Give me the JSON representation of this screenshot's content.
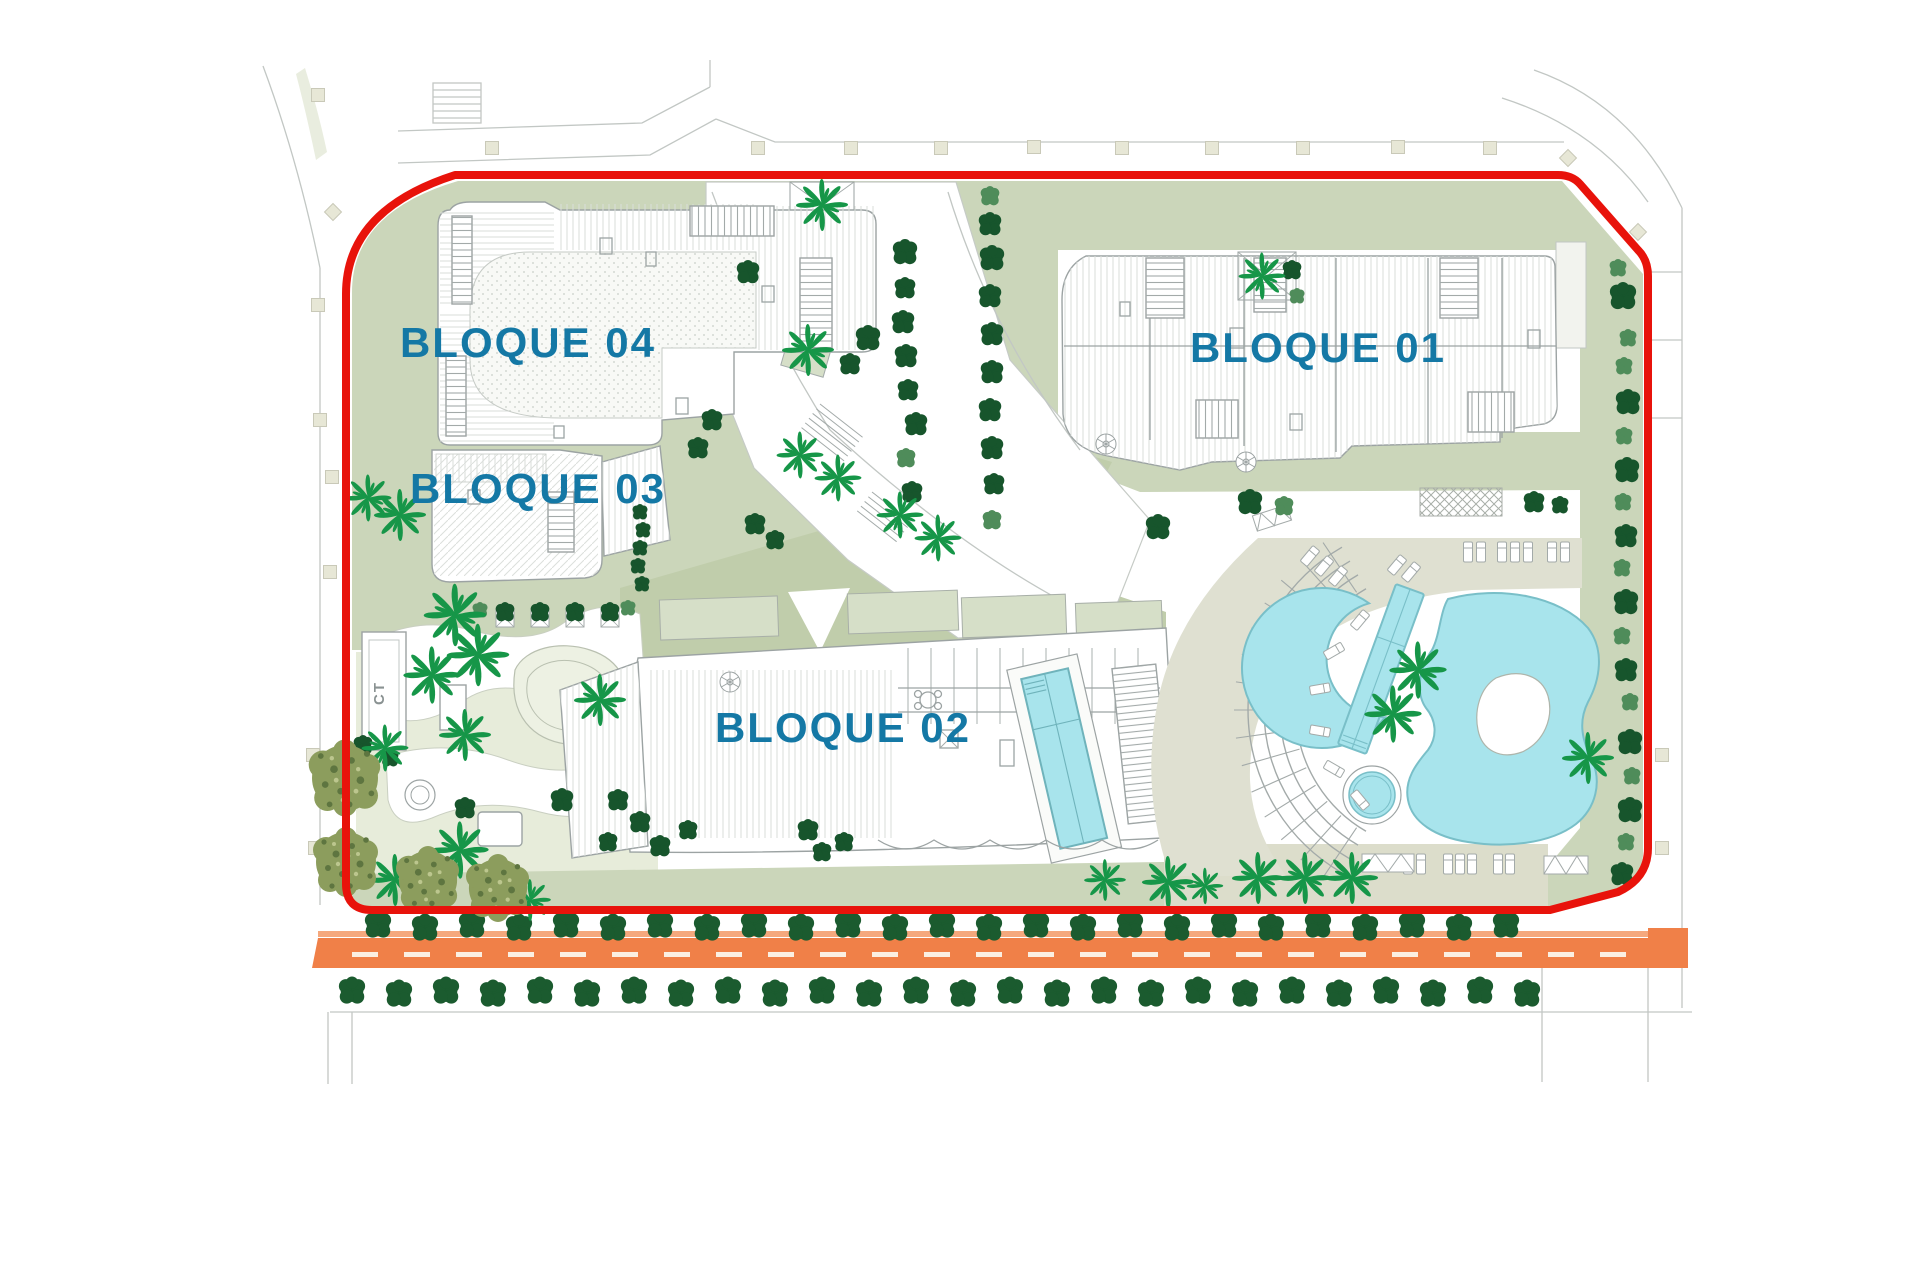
{
  "page": {
    "background": "#FFFFFF"
  },
  "site_plan": {
    "blocks": [
      {
        "id": "bloque-01",
        "label": "BLOQUE 01"
      },
      {
        "id": "bloque-02",
        "label": "BLOQUE 02"
      },
      {
        "id": "bloque-03",
        "label": "BLOQUE 03"
      },
      {
        "id": "bloque-04",
        "label": "BLOQUE 04"
      }
    ],
    "utility_box_label": "CT",
    "boundary_color": "#E8130B",
    "label_color": "#1478A5"
  },
  "colors": {
    "sage": "#CBD6BA",
    "sage_dark": "#C0CDAB",
    "planter_sage": "#D6DFC8",
    "deck": "#DFE0D1",
    "deck_dark": "#DCDDCB",
    "playground": "#E7ECDA",
    "pond": "#EDF1E3",
    "pool_water": "#A8E4EC",
    "pool_edge": "#79BFC8",
    "road": "#F08048",
    "road_light": "#F5A87D",
    "road_dash": "#FBEFE2",
    "tree_dark": "#17552C",
    "tree_mid": "#4F8C5A",
    "tree_row": "#1B5B2F",
    "palm": "#169648",
    "building_line": "#9CA3A3"
  },
  "vegetation": {
    "trees": [
      [
        905,
        252,
        13,
        "d"
      ],
      [
        905,
        288,
        11,
        "d"
      ],
      [
        903,
        322,
        12,
        "d"
      ],
      [
        906,
        356,
        12,
        "d"
      ],
      [
        908,
        390,
        11,
        "d"
      ],
      [
        916,
        424,
        12,
        "d"
      ],
      [
        906,
        458,
        10,
        "m"
      ],
      [
        912,
        492,
        11,
        "d"
      ],
      [
        990,
        196,
        10,
        "m"
      ],
      [
        990,
        224,
        12,
        "d"
      ],
      [
        992,
        258,
        13,
        "d"
      ],
      [
        990,
        296,
        12,
        "d"
      ],
      [
        992,
        334,
        12,
        "d"
      ],
      [
        992,
        372,
        12,
        "d"
      ],
      [
        990,
        410,
        12,
        "d"
      ],
      [
        992,
        448,
        12,
        "d"
      ],
      [
        994,
        484,
        11,
        "d"
      ],
      [
        992,
        520,
        10,
        "m"
      ],
      [
        1618,
        268,
        9,
        "m"
      ],
      [
        1623,
        296,
        14,
        "d"
      ],
      [
        1628,
        338,
        9,
        "m"
      ],
      [
        1624,
        366,
        9,
        "m"
      ],
      [
        1628,
        402,
        13,
        "d"
      ],
      [
        1624,
        436,
        9,
        "m"
      ],
      [
        1627,
        470,
        13,
        "d"
      ],
      [
        1623,
        502,
        9,
        "m"
      ],
      [
        1626,
        536,
        12,
        "d"
      ],
      [
        1622,
        568,
        9,
        "m"
      ],
      [
        1626,
        602,
        13,
        "d"
      ],
      [
        1622,
        636,
        9,
        "m"
      ],
      [
        1626,
        670,
        12,
        "d"
      ],
      [
        1630,
        702,
        9,
        "m"
      ],
      [
        1630,
        742,
        13,
        "d"
      ],
      [
        1632,
        776,
        9,
        "m"
      ],
      [
        1630,
        810,
        13,
        "d"
      ],
      [
        1626,
        842,
        9,
        "m"
      ],
      [
        1622,
        874,
        12,
        "d"
      ],
      [
        748,
        272,
        12,
        "d"
      ],
      [
        868,
        338,
        13,
        "d"
      ],
      [
        850,
        364,
        11,
        "d"
      ],
      [
        712,
        420,
        11,
        "d"
      ],
      [
        698,
        448,
        11,
        "d"
      ],
      [
        1158,
        527,
        13,
        "d"
      ],
      [
        1250,
        502,
        13,
        "d"
      ],
      [
        1284,
        506,
        10,
        "m"
      ],
      [
        755,
        524,
        11,
        "d"
      ],
      [
        775,
        540,
        10,
        "d"
      ],
      [
        1534,
        502,
        11,
        "d"
      ],
      [
        1560,
        505,
        9,
        "d"
      ],
      [
        1292,
        270,
        10,
        "d"
      ],
      [
        1297,
        296,
        8,
        "m"
      ],
      [
        640,
        512,
        8,
        "d"
      ],
      [
        643,
        530,
        8,
        "d"
      ],
      [
        640,
        548,
        8,
        "d"
      ],
      [
        638,
        566,
        8,
        "d"
      ],
      [
        642,
        584,
        8,
        "d"
      ],
      [
        480,
        610,
        8,
        "m"
      ],
      [
        628,
        608,
        8,
        "m"
      ],
      [
        505,
        612,
        10,
        "d"
      ],
      [
        540,
        612,
        10,
        "d"
      ],
      [
        575,
        612,
        10,
        "d"
      ],
      [
        610,
        612,
        10,
        "d"
      ],
      [
        465,
        808,
        11,
        "d"
      ],
      [
        562,
        800,
        12,
        "d"
      ],
      [
        618,
        800,
        11,
        "d"
      ],
      [
        640,
        822,
        11,
        "d"
      ],
      [
        608,
        842,
        10,
        "d"
      ],
      [
        660,
        846,
        11,
        "d"
      ],
      [
        688,
        830,
        10,
        "d"
      ],
      [
        363,
        745,
        10,
        "d"
      ],
      [
        390,
        758,
        9,
        "d"
      ],
      [
        808,
        830,
        11,
        "d"
      ],
      [
        822,
        852,
        10,
        "d"
      ],
      [
        844,
        842,
        10,
        "d"
      ]
    ],
    "tree_rows": [
      {
        "x0": 378,
        "y": 926,
        "step": 47,
        "n": 25,
        "r": 14
      },
      {
        "x0": 352,
        "y": 992,
        "step": 47,
        "n": 26,
        "r": 14
      }
    ],
    "palms": [
      [
        455,
        615,
        1.2
      ],
      [
        478,
        655,
        1.2
      ],
      [
        432,
        675,
        1.1
      ],
      [
        600,
        700,
        1.0
      ],
      [
        465,
        735,
        1.0
      ],
      [
        385,
        748,
        0.9
      ],
      [
        460,
        850,
        1.1
      ],
      [
        395,
        880,
        1.0
      ],
      [
        530,
        900,
        0.8
      ],
      [
        808,
        350,
        1.0
      ],
      [
        822,
        205,
        1.0
      ],
      [
        800,
        455,
        0.9
      ],
      [
        838,
        478,
        0.9
      ],
      [
        900,
        515,
        0.9
      ],
      [
        938,
        538,
        0.9
      ],
      [
        1262,
        276,
        0.9
      ],
      [
        1418,
        670,
        1.1
      ],
      [
        1393,
        714,
        1.1
      ],
      [
        1588,
        758,
        1.0
      ],
      [
        1168,
        882,
        1.0
      ],
      [
        1205,
        886,
        0.7
      ],
      [
        1258,
        878,
        1.0
      ],
      [
        1305,
        878,
        1.0
      ],
      [
        1352,
        878,
        1.0
      ],
      [
        1105,
        880,
        0.8
      ],
      [
        368,
        498,
        0.9
      ],
      [
        400,
        515,
        1.0
      ]
    ],
    "olives": [
      [
        345,
        778,
        1.1
      ],
      [
        346,
        862,
        1.0
      ],
      [
        428,
        880,
        0.97
      ],
      [
        498,
        888,
        0.97
      ]
    ]
  },
  "pool_area": {
    "amphitheater": {
      "cx": 1436,
      "cy": 710,
      "radii": [
        140,
        156,
        172,
        188
      ],
      "beam_inner": 142,
      "beam_outer": 202,
      "beam_start": -56,
      "beam_end": 56,
      "beam_step": 8
    },
    "loungers": [
      [
        1360,
        620,
        40
      ],
      [
        1334,
        651,
        60
      ],
      [
        1320,
        689,
        80
      ],
      [
        1320,
        731,
        100
      ],
      [
        1334,
        769,
        120
      ],
      [
        1360,
        800,
        140
      ],
      [
        1468,
        552,
        0
      ],
      [
        1481,
        552,
        0
      ],
      [
        1502,
        552,
        0
      ],
      [
        1515,
        552,
        0
      ],
      [
        1528,
        552,
        0
      ],
      [
        1552,
        552,
        0
      ],
      [
        1565,
        552,
        0
      ],
      [
        1310,
        556,
        40
      ],
      [
        1324,
        566,
        40
      ],
      [
        1338,
        576,
        40
      ],
      [
        1397,
        565,
        40
      ],
      [
        1411,
        572,
        40
      ],
      [
        1408,
        864,
        0
      ],
      [
        1421,
        864,
        0
      ],
      [
        1448,
        864,
        0
      ],
      [
        1460,
        864,
        0
      ],
      [
        1472,
        864,
        0
      ],
      [
        1498,
        864,
        0
      ],
      [
        1510,
        864,
        0
      ]
    ]
  },
  "road": {
    "surface_color": "#F08048",
    "dashes": {
      "x0": 352,
      "y": 952,
      "w": 26,
      "h": 5,
      "step": 52,
      "n": 25
    }
  },
  "pavement_markers": {
    "squares": [
      [
        492,
        148
      ],
      [
        758,
        148
      ],
      [
        851,
        148
      ],
      [
        941,
        148
      ],
      [
        1034,
        147
      ],
      [
        1122,
        148
      ],
      [
        1212,
        148
      ],
      [
        1303,
        148
      ],
      [
        1398,
        147
      ],
      [
        1490,
        148
      ],
      [
        318,
        95
      ],
      [
        318,
        305
      ],
      [
        320,
        420
      ],
      [
        332,
        477
      ],
      [
        330,
        572
      ],
      [
        313,
        755
      ],
      [
        315,
        848
      ],
      [
        1662,
        755
      ],
      [
        1662,
        848
      ]
    ],
    "diamonds": [
      [
        1568,
        158
      ],
      [
        1638,
        232
      ],
      [
        333,
        212
      ]
    ]
  }
}
